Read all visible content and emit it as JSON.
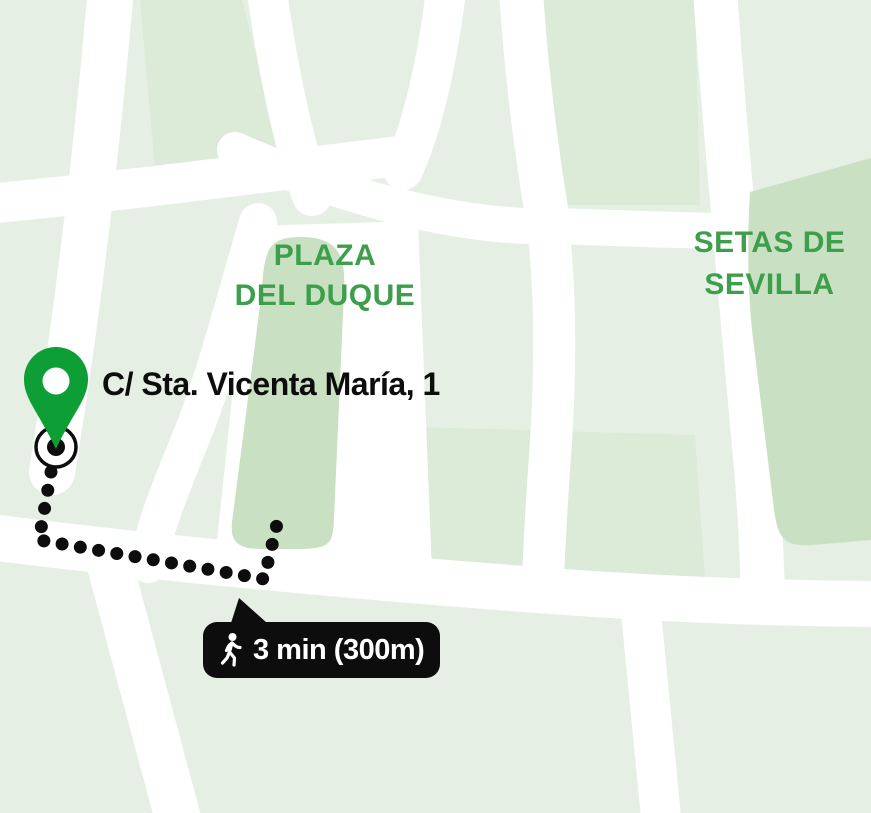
{
  "colors": {
    "bg": "#e5efe4",
    "block": "#dcead8",
    "park": "#c9e0c2",
    "road": "#ffffff",
    "pin": "#0d9f36",
    "label": "#3d9e4b",
    "ink": "#0d0d0d",
    "badge-bg": "#0d0d0d",
    "badge-fg": "#ffffff"
  },
  "labels": {
    "plaza_line1": "PLAZA",
    "plaza_line2": "DEL DUQUE",
    "setas_line1": "SETAS DE",
    "setas_line2": "SEVILLA"
  },
  "destination": {
    "address": "C/ Sta. Vicenta María, 1"
  },
  "route": {
    "duration_distance": "3 min (300m)"
  },
  "icons": {
    "pin": "map-pin",
    "origin": "origin-ring-dot",
    "walk": "walking-person",
    "tail": "speech-bubble-tail"
  }
}
